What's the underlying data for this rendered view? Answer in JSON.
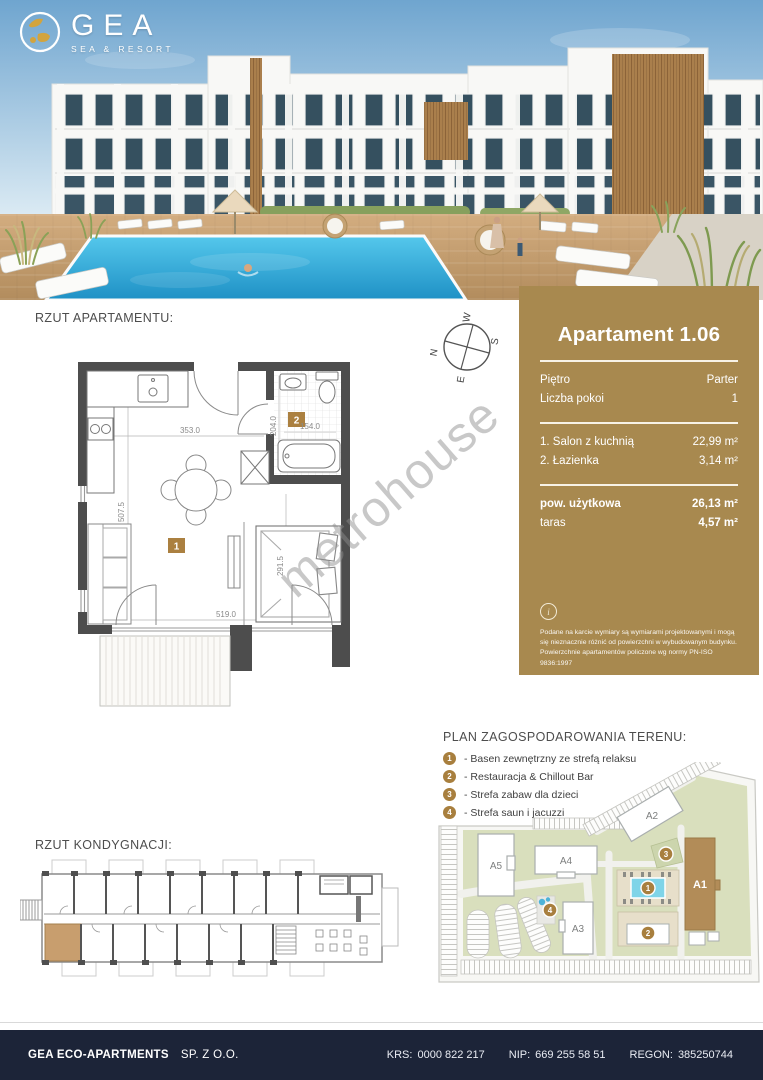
{
  "logo": {
    "name": "GEA",
    "tagline": "SEA & RESORT"
  },
  "sections": {
    "apartment_plan": "RZUT APARTAMENTU:",
    "site_plan": "PLAN ZAGOSPODAROWANIA TERENU:",
    "floor_plan": "RZUT KONDYGNACJI:"
  },
  "compass": {
    "n": "N",
    "s": "S",
    "e": "E",
    "w": "W"
  },
  "unit_card": {
    "title": "Apartament 1.06",
    "accent_color": "#a8894f",
    "meta": [
      {
        "label": "Piętro",
        "value": "Parter"
      },
      {
        "label": "Liczba pokoi",
        "value": "1"
      }
    ],
    "rooms": [
      {
        "label": "1. Salon z kuchnią",
        "value": "22,99 m²"
      },
      {
        "label": "2. Łazienka",
        "value": "3,14 m²"
      }
    ],
    "totals": [
      {
        "label": "pow. użytkowa",
        "value": "26,13 m²"
      },
      {
        "label": "taras",
        "value": "4,57 m²"
      }
    ],
    "info_icon_glyph": "i",
    "disclaimer": "Podane na karcie wymiary są wymiarami projektowanymi i mogą się nieznacznie różnić od powierzchni w wybudowanym budynku. Powierzchnie apartamentów policzone wg normy PN-ISO 9836:1997"
  },
  "apartment_plan": {
    "room1_label": "1",
    "room2_label": "2",
    "label_color": "#ab8040",
    "dims": {
      "living_width": "353.0",
      "living_height": "507.5",
      "bottom_width": "519.0",
      "bedroom_height": "291.5",
      "bath_width": "154.0",
      "bath_height": "204.0"
    }
  },
  "legend": {
    "items": [
      {
        "num": "1",
        "label": "- Basen zewnętrzny ze strefą relaksu"
      },
      {
        "num": "2",
        "label": "- Restauracja & Chillout Bar"
      },
      {
        "num": "3",
        "label": "- Strefa zabaw dla dzieci"
      },
      {
        "num": "4",
        "label": "- Strefa saun i jacuzzi"
      }
    ]
  },
  "site_plan": {
    "buildings": {
      "a1": "A1",
      "a2": "A2",
      "a3": "A3",
      "a4": "A4",
      "a5": "A5"
    },
    "markers": {
      "m1": "1",
      "m2": "2",
      "m3": "3",
      "m4": "4"
    },
    "highlight_color": "#b28c58"
  },
  "watermark": "metrohouse",
  "footer": {
    "company": "GEA ECO-APARTMENTS",
    "company_suffix": "SP. Z O.O.",
    "registry": [
      {
        "label": "KRS:",
        "value": "0000 822 217"
      },
      {
        "label": "NIP:",
        "value": "669 255 58 51"
      },
      {
        "label": "REGON:",
        "value": "385250744"
      }
    ]
  }
}
